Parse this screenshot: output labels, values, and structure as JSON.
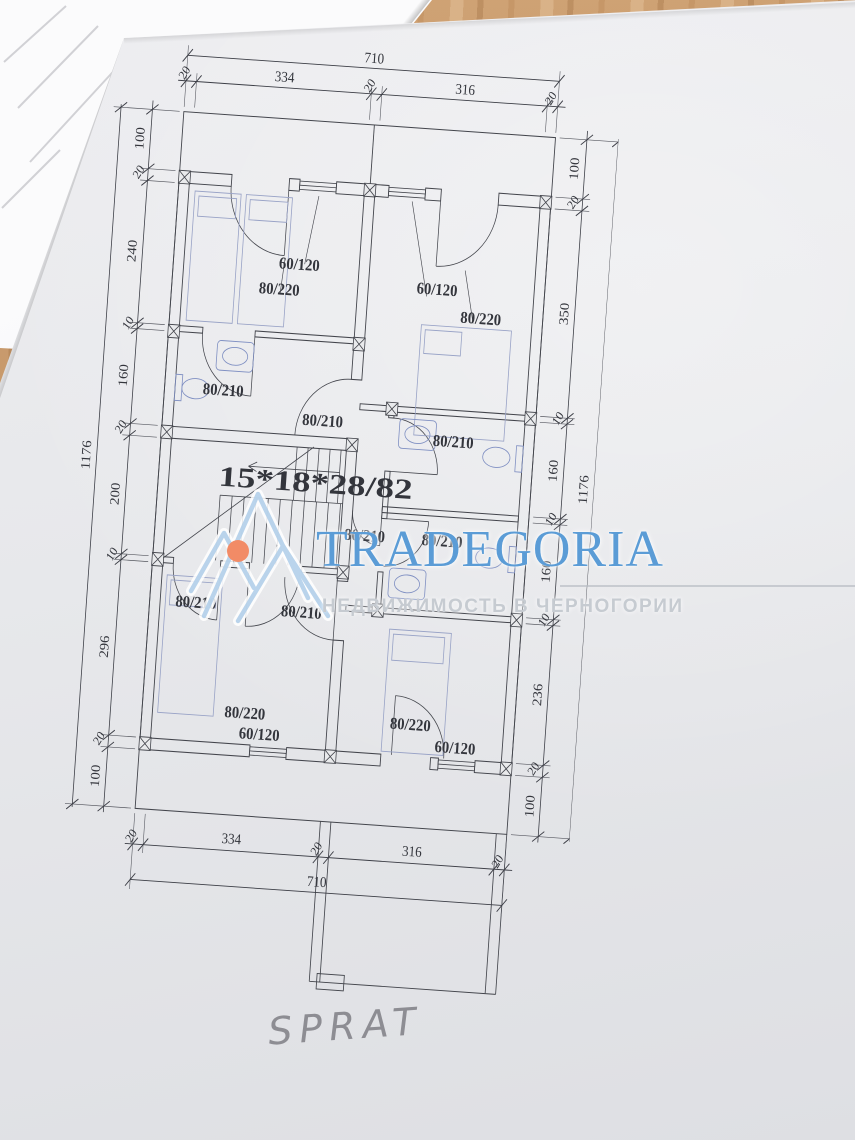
{
  "photo": {
    "surface": "wooden-table",
    "handwritten_label": "SPRAT"
  },
  "watermark": {
    "title": "TRADEGORIA",
    "subtitle": "НЕДВИЖИМОСТЬ В ЧЕРНОГОРИИ",
    "title_color": "#5b9cd6",
    "subtitle_color": "#c6cbd1",
    "logo_color": "#aecde9",
    "logo_dot_color": "#f28b66"
  },
  "plan": {
    "stair_note": "15*18*28/82",
    "room_labels": [
      {
        "text": "60/120",
        "item": "window",
        "room": "top-left"
      },
      {
        "text": "80/220",
        "item": "door",
        "room": "top-left"
      },
      {
        "text": "60/120",
        "item": "window",
        "room": "top-right"
      },
      {
        "text": "80/220",
        "item": "door",
        "room": "top-right"
      },
      {
        "text": "80/210",
        "item": "door",
        "room": "left-bathroom"
      },
      {
        "text": "80/210",
        "item": "door",
        "room": "stair-hall"
      },
      {
        "text": "80/210",
        "item": "door",
        "room": "upper-right-bathroom"
      },
      {
        "text": "80/210",
        "item": "door",
        "room": "corridor"
      },
      {
        "text": "80/210",
        "item": "door",
        "room": "lower-right-bathroom"
      },
      {
        "text": "80/210",
        "item": "door",
        "room": "bottom-left"
      },
      {
        "text": "80/210",
        "item": "door",
        "room": "bottom-middle"
      },
      {
        "text": "80/220",
        "item": "door",
        "room": "bottom-left"
      },
      {
        "text": "60/120",
        "item": "window",
        "room": "bottom-left"
      },
      {
        "text": "80/220",
        "item": "door",
        "room": "bottom-right"
      },
      {
        "text": "60/120",
        "item": "window",
        "room": "bottom-right"
      }
    ]
  },
  "dims": {
    "top": {
      "total": "710",
      "chain": [
        "20",
        "334",
        "20",
        "316",
        "20"
      ]
    },
    "bottom": {
      "total": "710",
      "chain": [
        "20",
        "334",
        "20",
        "316",
        "20"
      ]
    },
    "left": {
      "total": "1176",
      "chain": [
        "100",
        "20",
        "240",
        "10",
        "160",
        "20",
        "200",
        "10",
        "296",
        "20",
        "100"
      ]
    },
    "right": {
      "total": "1176",
      "chain": [
        "100",
        "20",
        "350",
        "10",
        "160",
        "10",
        "160",
        "10",
        "236",
        "20",
        "100"
      ]
    }
  }
}
